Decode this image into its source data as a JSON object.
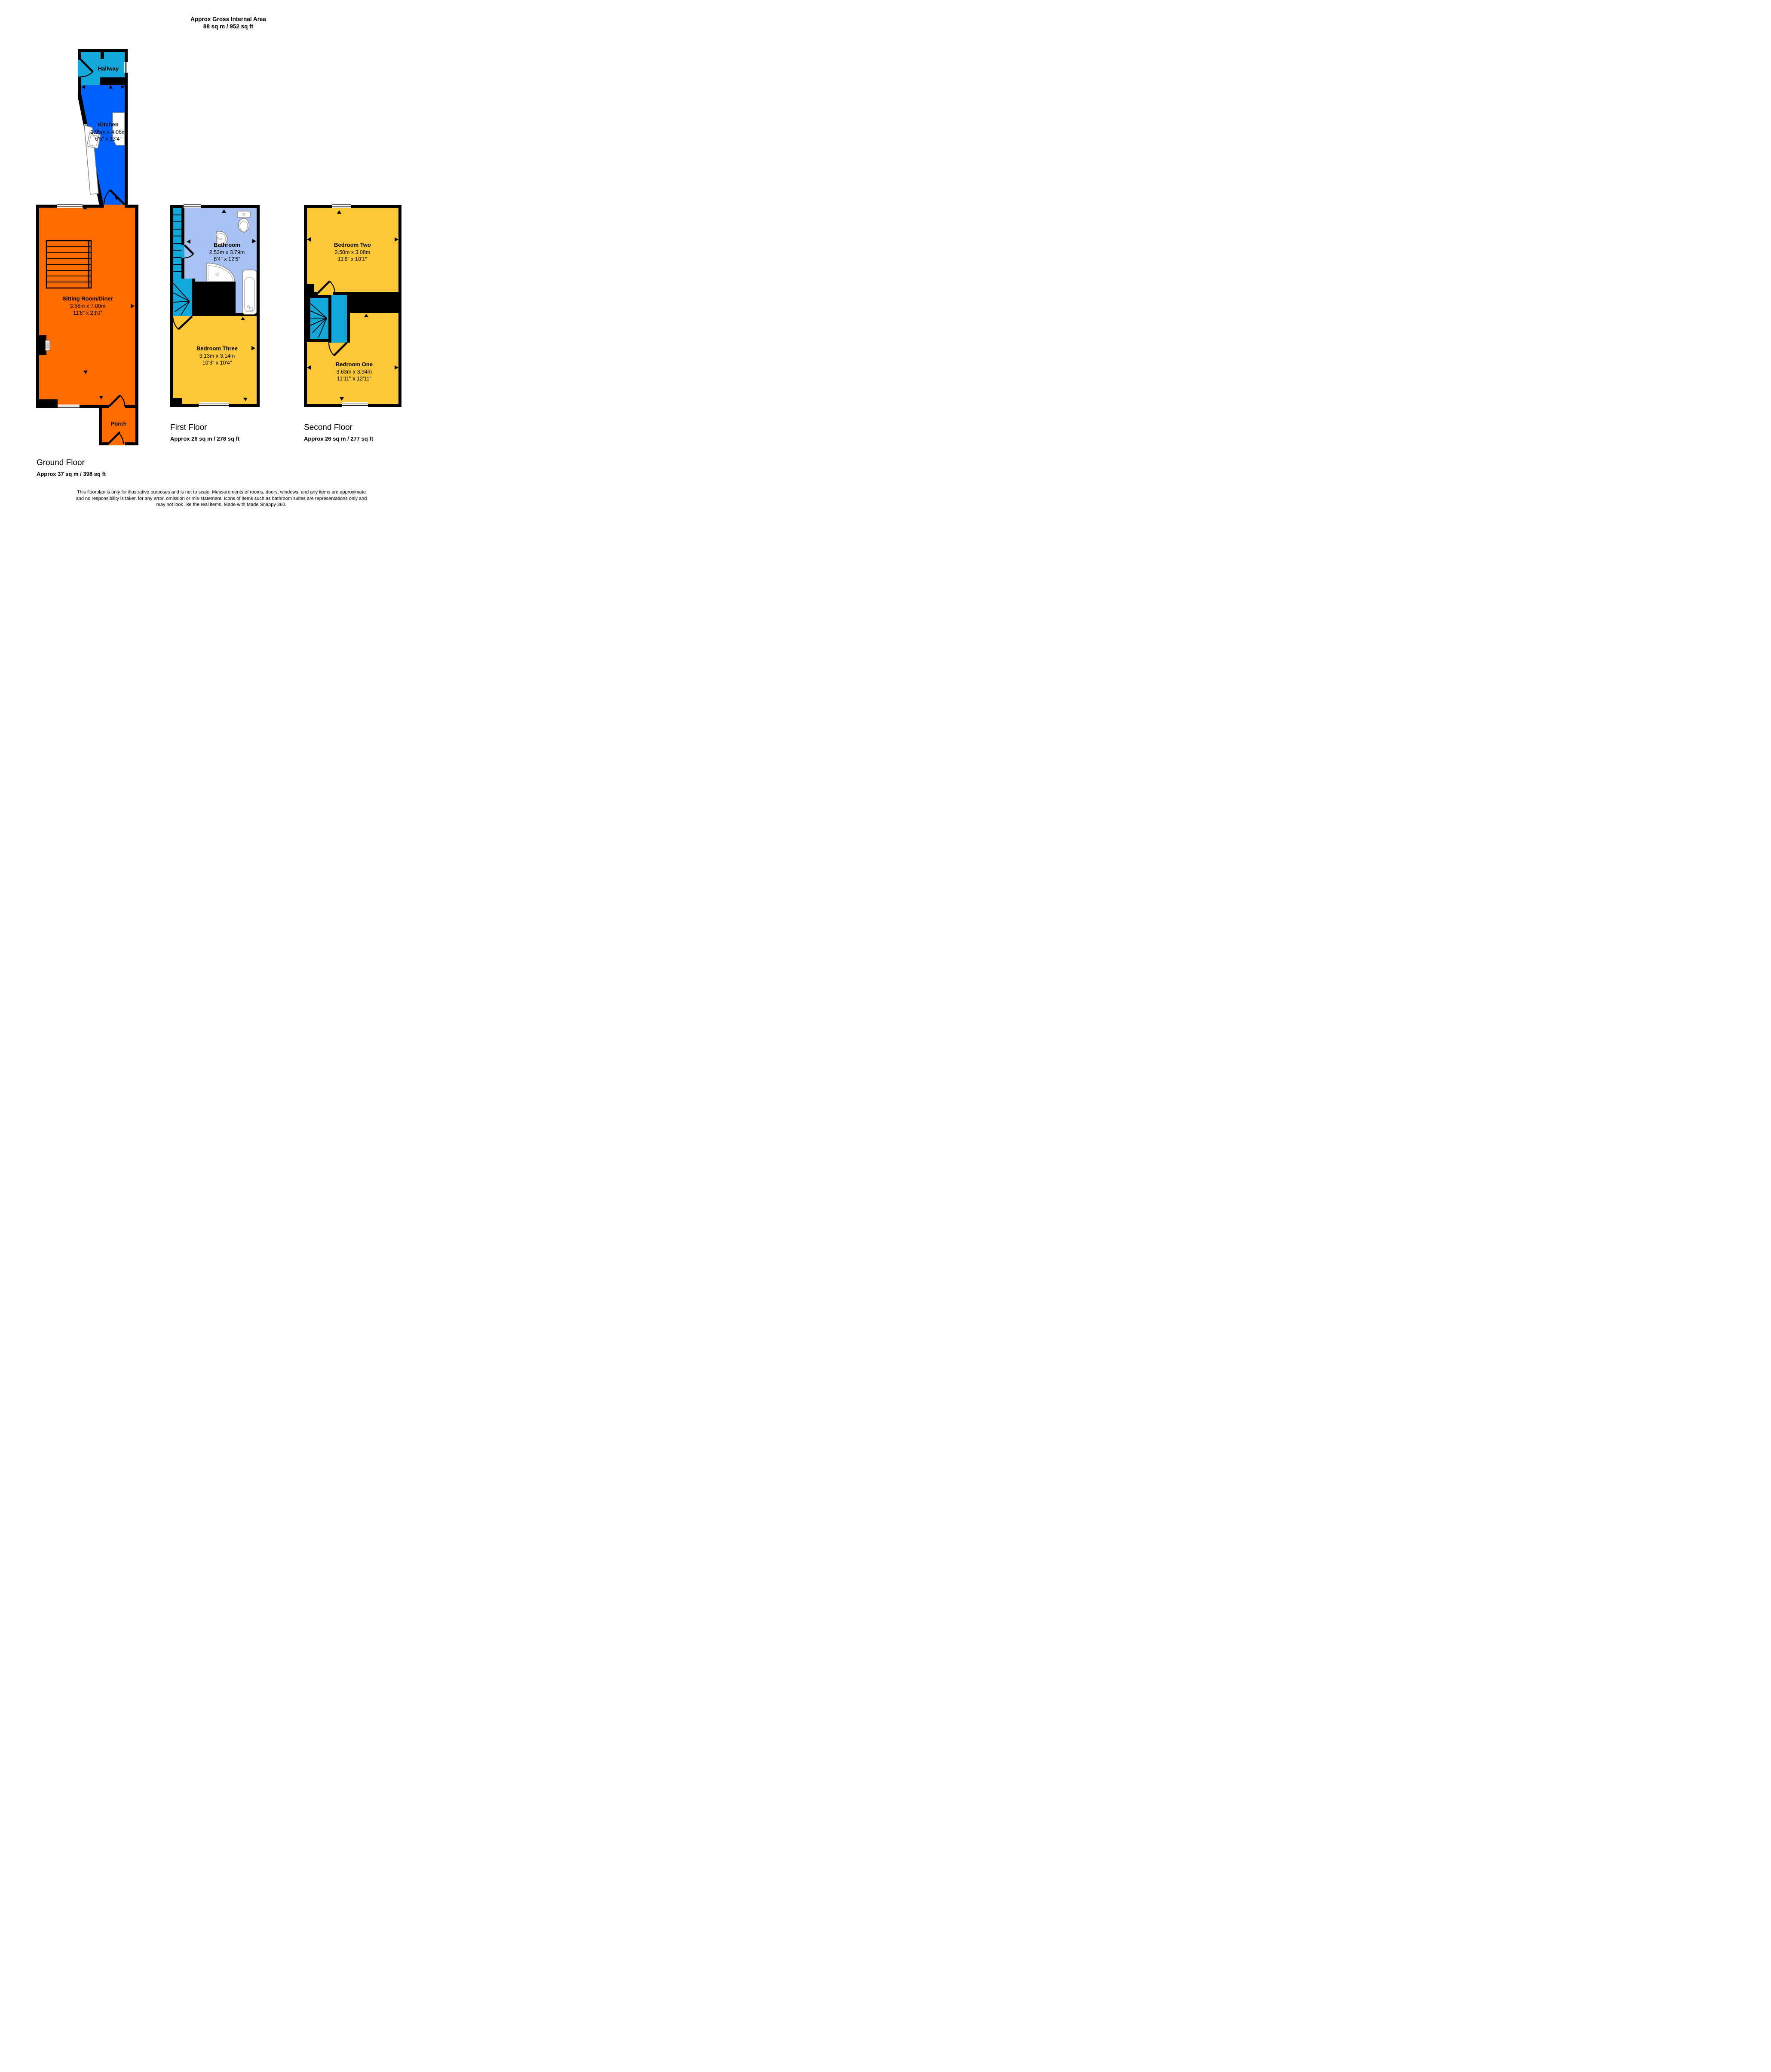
{
  "title": {
    "line1": "Approx Gross Internal Area",
    "line2": "88 sq m / 952 sq ft"
  },
  "colors": {
    "wall": "#000000",
    "hallway": "#14a7d9",
    "kitchen": "#0061fe",
    "sitting": "#ff6b00",
    "bedroom": "#fdc737",
    "bathroom": "#a8c3f3"
  },
  "floors": [
    {
      "label": "Ground Floor",
      "area": "Approx 37 sq m / 398 sq ft",
      "rooms": [
        {
          "name": "Hallway"
        },
        {
          "name": "Kitchen",
          "metric": "1.95m x 4.06m",
          "imperial": "6'5\" x 13'4\""
        },
        {
          "name": "Sitting Room/Diner",
          "metric": "3.56m x 7.00m",
          "imperial": "11'8\" x 23'0\""
        },
        {
          "name": "Porch"
        }
      ]
    },
    {
      "label": "First Floor",
      "area": "Approx 26 sq m / 278 sq ft",
      "rooms": [
        {
          "name": "Bathroom",
          "metric": "2.53m x 3.79m",
          "imperial": "8'4\" x 12'5\""
        },
        {
          "name": "Bedroom Three",
          "metric": "3.13m x 3.14m",
          "imperial": "10'3\" x 10'4\""
        }
      ]
    },
    {
      "label": "Second Floor",
      "area": "Approx 26 sq m / 277 sq ft",
      "rooms": [
        {
          "name": "Bedroom Two",
          "metric": "3.50m x 3.08m",
          "imperial": "11'6\" x 10'1\""
        },
        {
          "name": "Bedroom One",
          "metric": "3.63m x 3.94m",
          "imperial": "11'11\" x 12'11\""
        }
      ]
    }
  ],
  "footer": {
    "line1": "This floorplan is only for illustrative purposes and is not to scale. Measurements of rooms, doors, windows, and any items are approximate",
    "line2": "and no responsibility is taken for any error, omission or mis-statement. Icons of items such as bathroom suites are representations only and",
    "line3": "may not look like the real items. Made with Made Snappy 360."
  }
}
